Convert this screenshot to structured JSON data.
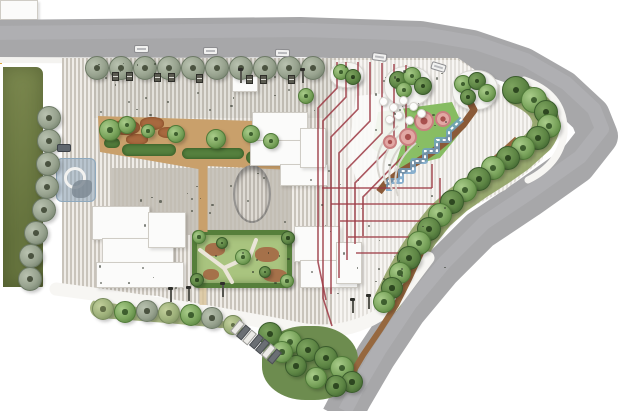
{
  "meta": {
    "title": "Residential landscape master plan (site plan rendering)",
    "canvas_w": 640,
    "canvas_h": 411
  },
  "palette": {
    "road": "#a7a7a9",
    "road_hi": "#b7b7b9",
    "page_bg": "#ffffff",
    "stripe_a": "#efece7",
    "stripe_b": "#c9c4bb",
    "white_path": "#f7f6f3",
    "sidewalk": "#f4f3f0",
    "parcel_1": "#7d8a50",
    "parcel_2": "#66743e",
    "tan": "#c9a06b",
    "mulch": "#a8693f",
    "hedge": "#55803e",
    "court_base": "#a9c47f",
    "court_border": "#567f3b",
    "court_brown": "#a5714a",
    "play_lawn": "#7cb457",
    "play_lawn_hi": "#97c973",
    "ribbon_1": "#8a5a38",
    "ribbon_2": "#96683f",
    "stream": "#6d9fc6",
    "red_path": "#9c3a44",
    "bed_olive": "#93a469",
    "bed_olive2": "#a3b37c",
    "cluster_bed": "#6d8c4f",
    "tr_street": "#97a28e",
    "tr_street_d": "#6d7a66",
    "tr_green": "#7aa45c",
    "tr_green_d": "#4f7a38",
    "tr_dark": "#5d8544",
    "tr_dark_d": "#3a5c2c",
    "tr_olive": "#9db07a",
    "tr_olive_d": "#76895a",
    "bld": "#fbfbfa",
    "bld_b": "#cfccc5",
    "water": "rgba(140,165,188,0.55)",
    "water_b": "#8fa9bd",
    "mound_ring": "#c97f7f",
    "mound_fill": "#e2a8a4",
    "mound_core": "#a8504e",
    "plaza_line": "#6f6f6f",
    "marker_red": "#a03030",
    "flag_yellow": "#d9a53c",
    "terrace_line": "#d8d5cf",
    "terrace_fill": "rgba(250,250,248,0.92)"
  },
  "paths": {
    "road": "M-12,40 L300,37 L420,41 L472,50 L522,67 L562,90 L590,116 L598,136 L576,164 L528,198 L480,230 L441,269 L406,311 L376,356 L352,397 L341,418",
    "white_bottom": "M56,289 Q180,305 300,329 Q352,338 392,306 L428,258",
    "white_corner": "M524,80 Q566,94 564,134 Q560,164 528,180",
    "sidewalk_top": "M0,60 L460,62",
    "bed_right": "M518,92 C548,106 552,124 540,140 L520,158 L500,172 L478,186 L458,200 L440,216 L424,236 L410,258 L398,280 L388,300",
    "bed_bottom": "M100,308 Q160,312 222,318",
    "ribbon_play": "M466,95 L474,110 L463,125 L449,139 L434,151 L417,162 L400,172 L387,182 L379,192",
    "ribbon_long": "M517,139 L494,160 L470,182 L450,204 L434,228 L421,253 L409,279 L396,305 L380,330 L363,355 L350,377",
    "stream": "M462,119 L449,131 L449,140 L437,140 L437,151 L425,151 L425,161 L413,161 L413,171 L401,171 L401,181 L389,181 L389,191",
    "garden_walk": "M203,166 L203,232",
    "garden_walk2": "M203,288 L203,305",
    "court_path": "M200,250 L224,268 L250,256 L256,240",
    "court_path2": "M224,268 L232,282"
  },
  "red_paths": [
    "M337,62 L337,88 L318,108 L318,262 L326,300",
    "M346,62 L346,97 L323,121 L323,298 L332,326",
    "M358,62 L358,109 L331,137 L331,294",
    "M370,62 L370,121 L339,153 L339,278",
    "M382,63 L382,133 L347,169 L347,260",
    "M394,64 L394,143 L355,183 L355,244",
    "M406,65 L406,153 L363,197 L363,236",
    "M322,188 L432,188",
    "M331,204 L440,204",
    "M340,221 L446,221",
    "M348,237 L422,237",
    "M356,253 L402,253",
    "M432,164 L432,188",
    "M440,178 L440,204",
    "M446,192 L446,221"
  ],
  "terrace_arcs": [
    "M398,126 Q370,148 380,178",
    "M404,131 Q376,154 386,184",
    "M410,137 Q382,160 392,190",
    "M416,143 Q388,166 398,196"
  ],
  "zones": {
    "site": "polygon(62px 58px,458px 58px,478px 72px,508px 90px,534px 114px,548px 136px,542px 160px,505px 190px,462px 212px,430px 248px,402px 288px,382px 312px,340px 332px,298px 330px,238px 318px,158px 296px,94px 291px,62px 288px)",
    "light_right": "polygon(332px 60px,458px 60px,478px 72px,508px 90px,534px 114px,548px 136px,542px 160px,505px 190px,462px 212px,430px 248px,402px 288px,382px 310px,344px 328px,332px 328px)",
    "dark_plaza": [
      112,
      168,
      180,
      67
    ],
    "top_mid": [
      94,
      58,
      240,
      60
    ],
    "terrace_wedge": "polygon(356px 96px,398px 92px,408px 124px,392px 176px,362px 196px,348px 156px)",
    "garden_poly": "polygon(98px 116px,288px 122px,292px 170px,206px 166px,204px 170px,100px 152px)",
    "lawn_poly": "polygon(378px 112px,452px 102px,464px 128px,440px 158px,400px 168px,372px 148px)"
  },
  "parcel": [
    0,
    64,
    46,
    226
  ],
  "water_feature": [
    56,
    158,
    40,
    44
  ],
  "courtyard": {
    "rect": [
      192,
      230,
      100,
      58
    ],
    "browns": [
      [
        8,
        8,
        20,
        13
      ],
      [
        58,
        12,
        24,
        15
      ],
      [
        66,
        34,
        24,
        13
      ],
      [
        6,
        34,
        16,
        11
      ]
    ]
  },
  "garden": {
    "mulch": [
      [
        112,
        120,
        28,
        15
      ],
      [
        140,
        117,
        24,
        13
      ],
      [
        158,
        127,
        20,
        11
      ],
      [
        126,
        134,
        22,
        11
      ]
    ],
    "hedges": [
      [
        122,
        144,
        54,
        12
      ],
      [
        182,
        148,
        62,
        11
      ],
      [
        246,
        151,
        42,
        13
      ],
      [
        104,
        138,
        16,
        10
      ]
    ],
    "white_struct": [
      100,
      140,
      38,
      20
    ]
  },
  "plaza_oval": {
    "rect": [
      233,
      165,
      38,
      58
    ],
    "dots": [
      [
        252,
        167
      ],
      [
        252,
        221
      ],
      [
        242,
        220
      ],
      [
        262,
        218
      ]
    ]
  },
  "buildings": [
    [
      252,
      112,
      56,
      30
    ],
    [
      250,
      140,
      62,
      26
    ],
    [
      280,
      164,
      48,
      22
    ],
    [
      300,
      128,
      26,
      40
    ],
    [
      232,
      76,
      26,
      16
    ],
    [
      92,
      206,
      58,
      34
    ],
    [
      102,
      238,
      72,
      30
    ],
    [
      96,
      262,
      88,
      26
    ],
    [
      148,
      212,
      38,
      36
    ],
    [
      294,
      226,
      46,
      36
    ],
    [
      300,
      260,
      58,
      28
    ],
    [
      336,
      242,
      26,
      42
    ]
  ],
  "islands": [
    [
      384,
      66,
      48,
      40
    ],
    [
      452,
      70,
      46,
      40
    ],
    [
      330,
      62,
      34,
      26
    ]
  ],
  "trees": {
    "street_row": {
      "y": 68,
      "r": 12,
      "xs": [
        97,
        121,
        145,
        169,
        193,
        217,
        241,
        265,
        289,
        313
      ]
    },
    "left_col": [
      [
        49,
        118
      ],
      [
        49,
        141
      ],
      [
        48,
        164
      ],
      [
        47,
        187
      ],
      [
        44,
        210
      ],
      [
        36,
        233
      ],
      [
        31,
        256
      ],
      [
        30,
        279
      ]
    ],
    "bottom_row": [
      [
        103,
        309,
        11,
        "olive"
      ],
      [
        125,
        312,
        11,
        "green"
      ],
      [
        147,
        311,
        11,
        "street"
      ],
      [
        169,
        313,
        11,
        "olive"
      ],
      [
        191,
        315,
        11,
        "green"
      ],
      [
        212,
        318,
        11,
        "street"
      ],
      [
        233,
        325,
        10,
        "olive"
      ]
    ],
    "se_cluster": [
      [
        270,
        334,
        12,
        "dark"
      ],
      [
        290,
        342,
        12,
        "green"
      ],
      [
        308,
        350,
        12,
        "dark"
      ],
      [
        326,
        358,
        12,
        "dark"
      ],
      [
        342,
        368,
        12,
        "green"
      ],
      [
        352,
        382,
        11,
        "dark"
      ],
      [
        336,
        386,
        11,
        "dark"
      ],
      [
        316,
        378,
        11,
        "green"
      ],
      [
        296,
        366,
        11,
        "dark"
      ],
      [
        282,
        352,
        11,
        "green"
      ]
    ],
    "right_band": [
      [
        516,
        90,
        14,
        "dark"
      ],
      [
        534,
        100,
        13,
        "green"
      ],
      [
        546,
        112,
        12,
        "dark"
      ],
      [
        549,
        126,
        12,
        "green"
      ],
      [
        538,
        138,
        12,
        "dark"
      ],
      [
        523,
        148,
        12,
        "green"
      ],
      [
        508,
        158,
        12,
        "dark"
      ],
      [
        493,
        168,
        12,
        "green"
      ],
      [
        479,
        179,
        12,
        "dark"
      ],
      [
        465,
        190,
        12,
        "green"
      ],
      [
        452,
        202,
        12,
        "dark"
      ],
      [
        440,
        215,
        12,
        "green"
      ],
      [
        429,
        229,
        12,
        "dark"
      ],
      [
        419,
        243,
        12,
        "green"
      ],
      [
        409,
        258,
        12,
        "dark"
      ],
      [
        400,
        273,
        11,
        "green"
      ],
      [
        392,
        288,
        11,
        "dark"
      ],
      [
        384,
        302,
        11,
        "green"
      ]
    ],
    "island_a": [
      [
        398,
        80,
        9,
        "dark"
      ],
      [
        412,
        76,
        9,
        "green"
      ],
      [
        423,
        86,
        9,
        "dark"
      ],
      [
        404,
        90,
        8,
        "green"
      ]
    ],
    "island_b": [
      [
        463,
        84,
        9,
        "green"
      ],
      [
        477,
        81,
        9,
        "dark"
      ],
      [
        487,
        93,
        9,
        "green"
      ],
      [
        468,
        97,
        8,
        "dark"
      ]
    ],
    "island_c": [
      [
        341,
        72,
        8,
        "green"
      ],
      [
        353,
        77,
        8,
        "dark"
      ]
    ],
    "garden_trees": [
      [
        110,
        130,
        11,
        "green"
      ],
      [
        127,
        125,
        9,
        "green"
      ],
      [
        148,
        131,
        7,
        "green"
      ],
      [
        176,
        134,
        9,
        "green"
      ],
      [
        216,
        139,
        10,
        "green"
      ],
      [
        251,
        134,
        9,
        "green"
      ],
      [
        271,
        141,
        8,
        "green"
      ],
      [
        306,
        96,
        8,
        "green"
      ]
    ],
    "court_trees": [
      [
        199,
        237,
        7,
        "green"
      ],
      [
        288,
        238,
        7,
        "dark"
      ],
      [
        197,
        280,
        7,
        "dark"
      ],
      [
        287,
        281,
        7,
        "green"
      ],
      [
        243,
        257,
        8,
        "green"
      ],
      [
        222,
        243,
        6,
        "dark"
      ],
      [
        265,
        272,
        6,
        "dark"
      ]
    ]
  },
  "mounds": [
    [
      424,
      121,
      10
    ],
    [
      443,
      119,
      8
    ],
    [
      408,
      137,
      9
    ],
    [
      390,
      142,
      7
    ]
  ],
  "canopies": [
    [
      383,
      101
    ],
    [
      393,
      107
    ],
    [
      403,
      100
    ],
    [
      413,
      106
    ],
    [
      421,
      113
    ],
    [
      398,
      115
    ],
    [
      389,
      119
    ],
    [
      409,
      120
    ]
  ],
  "cars_road": [
    [
      134,
      45,
      0
    ],
    [
      203,
      47,
      0
    ],
    [
      275,
      49,
      1
    ],
    [
      372,
      53,
      8
    ],
    [
      431,
      63,
      17
    ]
  ],
  "car_site": [
    57,
    144
  ],
  "parking_stalls": {
    "x": 234,
    "y": 320,
    "count": 7,
    "dx": 6.2,
    "dy": 4.8,
    "angle": 40,
    "full": [
      1,
      3,
      4,
      6
    ]
  },
  "lamps": [
    [
      170,
      289
    ],
    [
      188,
      288
    ],
    [
      222,
      284
    ],
    [
      352,
      300
    ],
    [
      368,
      296
    ],
    [
      302,
      70
    ],
    [
      240,
      70
    ]
  ],
  "racks": [
    [
      112,
      72
    ],
    [
      126,
      72
    ],
    [
      154,
      73
    ],
    [
      168,
      73
    ],
    [
      196,
      74
    ],
    [
      246,
      75
    ],
    [
      260,
      75
    ],
    [
      288,
      75
    ]
  ],
  "marker_red": [
    73,
    78
  ],
  "flag": [
    318,
    68
  ],
  "texture": {
    "seed": 11,
    "zones": [
      [
        95,
        62,
        355,
        52,
        30
      ],
      [
        112,
        172,
        175,
        58,
        16
      ],
      [
        300,
        150,
        150,
        145,
        26
      ],
      [
        95,
        250,
        195,
        42,
        14
      ],
      [
        360,
        70,
        90,
        80,
        10
      ]
    ]
  }
}
